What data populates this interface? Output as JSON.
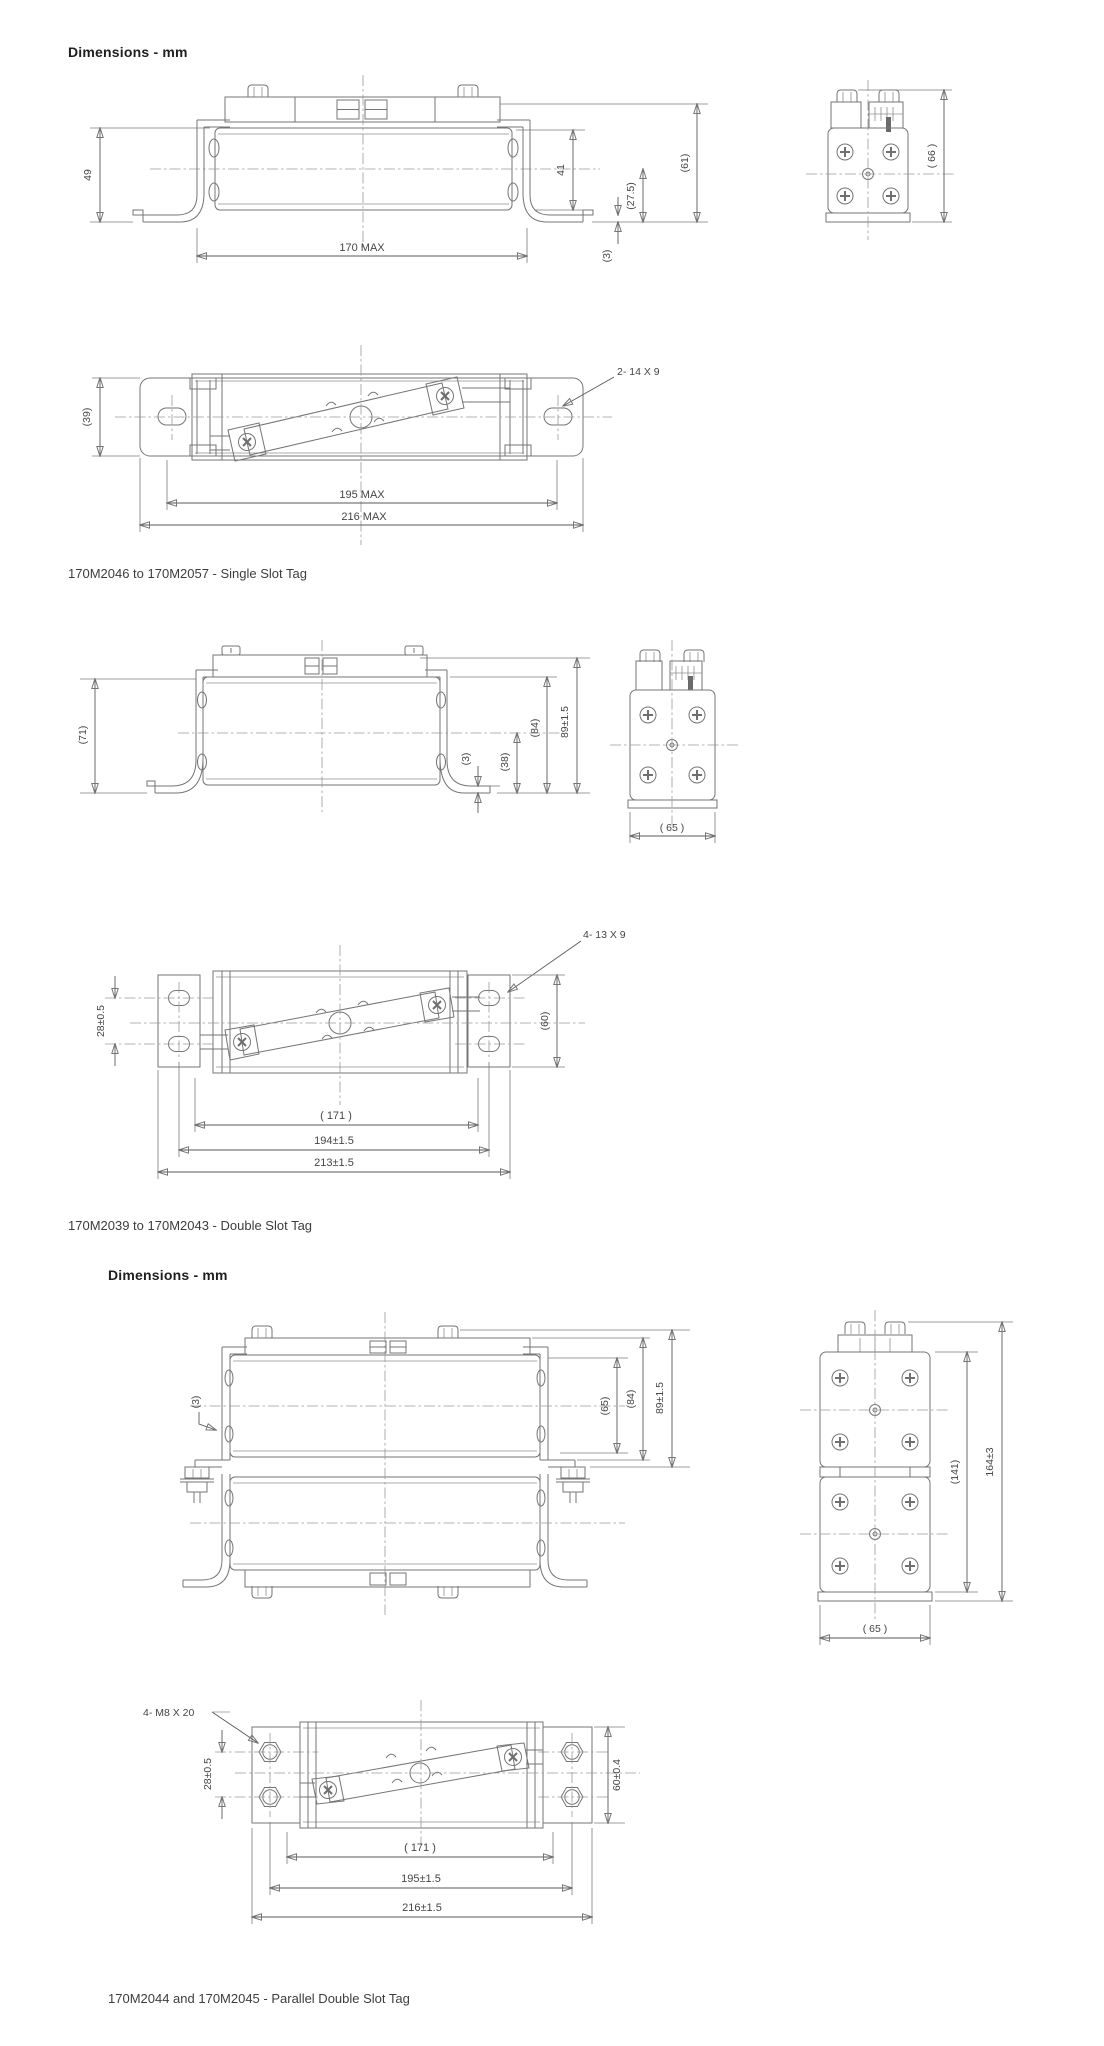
{
  "page": {
    "title_1": "Dimensions - mm",
    "title_2": "Dimensions - mm"
  },
  "captions": {
    "single_slot": "170M2046 to 170M2057 - Single Slot Tag",
    "double_slot": "170M2039 to 170M2043 - Double Slot Tag",
    "parallel_double_slot": "170M2044 and 170M2045 - Parallel Double Slot Tag"
  },
  "colors": {
    "drawing_line": "#757575",
    "dimension_text": "#454545",
    "heading_text": "#1f1f1f"
  },
  "dims": {
    "single_side": {
      "h49": "49",
      "h41": "41",
      "h27_5": "(27.5)",
      "h61": "(61)",
      "t3": "(3)",
      "len170": "170 MAX"
    },
    "single_end": {
      "w66": "( 66 )"
    },
    "single_plan": {
      "w39": "(39)",
      "slot_note": "2- 14 X 9",
      "len195": "195 MAX",
      "len216": "216 MAX"
    },
    "double_side": {
      "h71": "(71)",
      "t3": "(3)",
      "h38": "(38)",
      "h84": "(84)",
      "h89": "89±1.5"
    },
    "double_end": {
      "w65": "( 65 )"
    },
    "double_plan": {
      "slot_note": "4- 13 X 9",
      "pitch28": "28±0.5",
      "w60": "(60)",
      "len171": "( 171 )",
      "len194": "194±1.5",
      "len213": "213±1.5"
    },
    "parallel_side": {
      "t3": "(3)",
      "h65": "(65)",
      "h84": "(84)",
      "h89": "89±1.5"
    },
    "parallel_end": {
      "h141": "(141)",
      "h164": "164±3",
      "w65": "( 65 )"
    },
    "parallel_plan": {
      "bolt_note": "4- M8 X 20",
      "pitch28": "28±0.5",
      "w60": "60±0.4",
      "len171": "( 171 )",
      "len195": "195±1.5",
      "len216": "216±1.5"
    }
  }
}
